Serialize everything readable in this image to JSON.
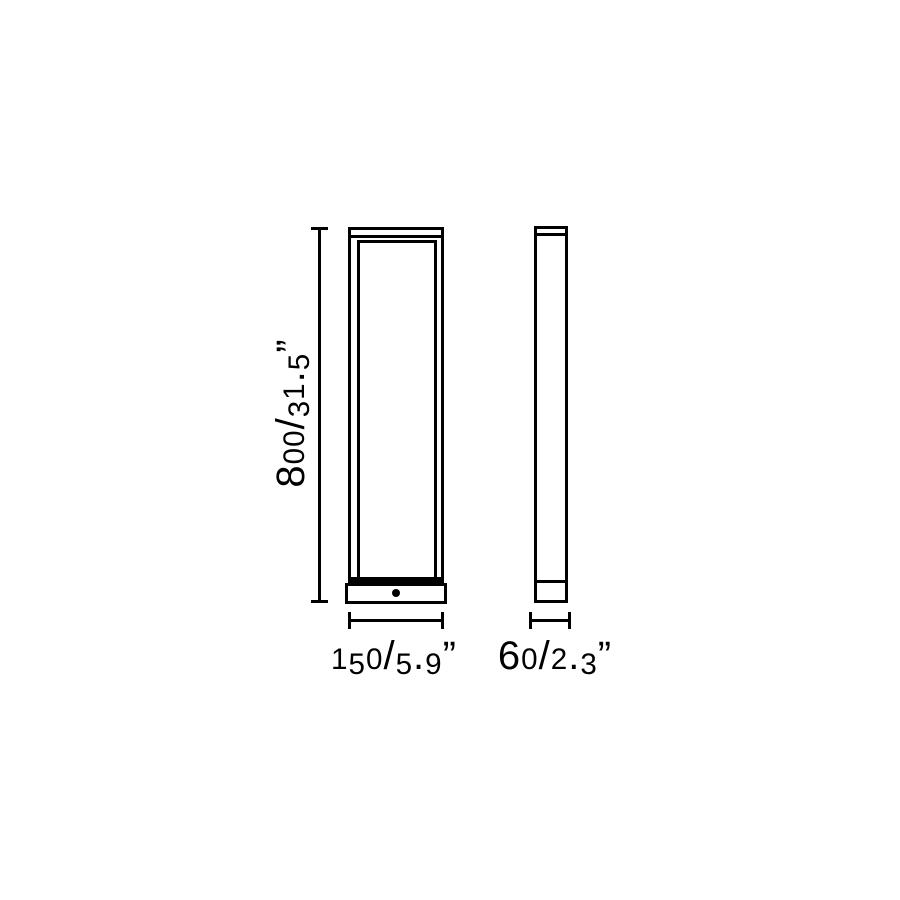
{
  "colors": {
    "background": "#ffffff",
    "line": "#000000"
  },
  "dimensions": {
    "height": {
      "label": "800/31.5”",
      "mm": "800",
      "inches": "31.5"
    },
    "width": {
      "label": "150/5.9”",
      "mm": "150",
      "inches": "5.9"
    },
    "depth": {
      "label": "60/2.3”",
      "mm": "60",
      "inches": "2.3"
    }
  }
}
